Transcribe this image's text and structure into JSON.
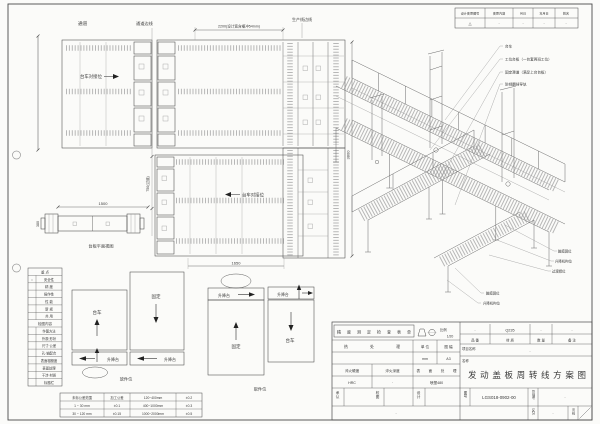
{
  "revision": {
    "headers": [
      "设计变更图号",
      "变更内容",
      "月日",
      "年月日",
      "姓名"
    ],
    "values": [
      "△",
      "·",
      "·",
      "·",
      "·"
    ]
  },
  "plan": {
    "passage": "通道",
    "passage_edge": "通道边线",
    "production_edge": "生产线边线",
    "dim_width": "2200(设计宽含缓冲54mm)",
    "dock_label_top": "台车对接位",
    "dock_label_bottom": "台车对接位",
    "dim_length": "1650",
    "dim_aisle": "750(过道)",
    "dim_height": "3800"
  },
  "side_view": {
    "dim_length": "1500",
    "dim_width": "380",
    "caption": "台板平面视图"
  },
  "iso": {
    "labels_top": [
      "台车",
      "工位台板（一台套两班工位）",
      "固定滑道（满足上台台板）",
      "防倾翻挡导轨"
    ],
    "labels_right": [
      "触摸屏位",
      "升降机构位",
      "过渡辊位"
    ],
    "labels_lower": [
      "触摸屏位",
      "升降机构位"
    ]
  },
  "details": {
    "cart": "台车",
    "fixed": "固定",
    "lift": "升降台",
    "caption_load": "放件位",
    "caption_unload": "取件位"
  },
  "checklist": {
    "title": "重  点",
    "check_mark": "○",
    "items": [
      "安全性",
      "精 度",
      "操作性",
      "性 能",
      "新 规",
      "共 用"
    ],
    "section": "检图内容",
    "items2": [
      "作图方法",
      "外观·形状",
      "尺寸·公差",
      "孔·轴配合",
      "表面粗糙度",
      "表面处理",
      "干涉·材质",
      "标题栏"
    ]
  },
  "tolerance": {
    "rows": [
      [
        "未标公差范围",
        "加工公差",
        "120~400mm",
        "±0.2"
      ],
      [
        "1 ~ 30 mm",
        "±0.1",
        "400~1000mm",
        "±0.3"
      ],
      [
        "30 ~ 120 mm",
        "±0.15",
        "1000~2000mm",
        "±0.5"
      ]
    ]
  },
  "title_block": {
    "check_form": "精度测定检查表单",
    "scale_label": "比例",
    "scale_value": "1/20",
    "heat_label": "热 处 理",
    "unit_label": "单 位",
    "unit_value": "mm",
    "sheet_label": "图 幅",
    "sheet_value": "A3",
    "hardness_label": "淬火硬度",
    "hardness_value": "HRC",
    "depth_label": "淬火深度",
    "depth_value": "·",
    "surface_label": "表 面 处 理",
    "surface_value": "喷塑480",
    "approve_label": "承认",
    "check_label": "校图",
    "design_label": "设计",
    "bottom_note": "·",
    "part_no_value": "·",
    "material_value": "Q235",
    "qty_value": "·",
    "remark_value": "·",
    "part_no_label": "品 番",
    "material_label": "材 质",
    "qty_label": "数 量",
    "remark_label": "备 注",
    "project_label": "项目名称",
    "project_value": "·",
    "name_label": "名称",
    "name_value": "发动盖板周转线方案图",
    "drawing_no_label": "图号",
    "drawing_no_value": "LGS018-0902-00",
    "mgmt_label": "管理号",
    "mgmt_value": "·",
    "class_label": "区分",
    "class_value": "·",
    "page_label": "页码"
  }
}
